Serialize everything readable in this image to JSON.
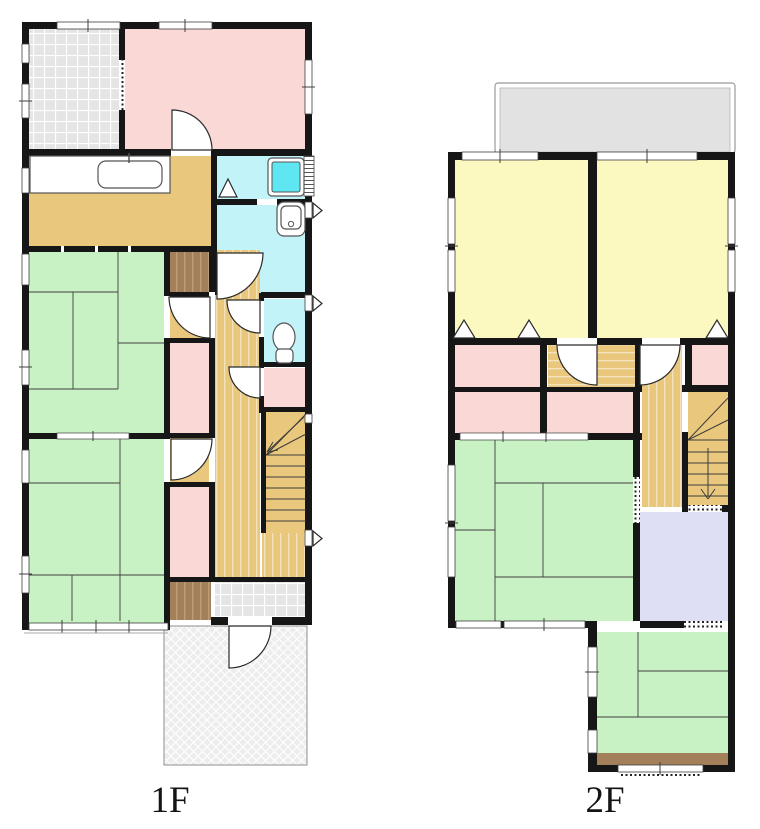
{
  "title": "House floor plan, two storeys",
  "floors": [
    {
      "label": "1F"
    },
    {
      "label": "2F"
    }
  ],
  "palette": {
    "wall": "#161616",
    "line": "#3f3f3f",
    "tatami": "#c8f1c4",
    "room_pink": "#f9d8d6",
    "room_yellow": "#fbf8c0",
    "bath": "#c2f3f9",
    "tub": "#5ee6f3",
    "wood": "#e9c87e",
    "wood_stripe": "#f4e3bd",
    "closet": "#a3805a",
    "closet_stripe": "#bd9d77",
    "lavender": "#dedff5",
    "tile": "#e5e5e5",
    "porch": "#ededed",
    "balcony": "#e2e2e2"
  },
  "icons": [
    "kitchen-sink-icon",
    "bathtub-icon",
    "shower-door-icon",
    "washbasin-icon",
    "toilet-icon",
    "stairs-up-icon",
    "stairs-down-icon",
    "door-swing-icon",
    "closet-door-icon",
    "window-icon",
    "casement-window-icon"
  ]
}
